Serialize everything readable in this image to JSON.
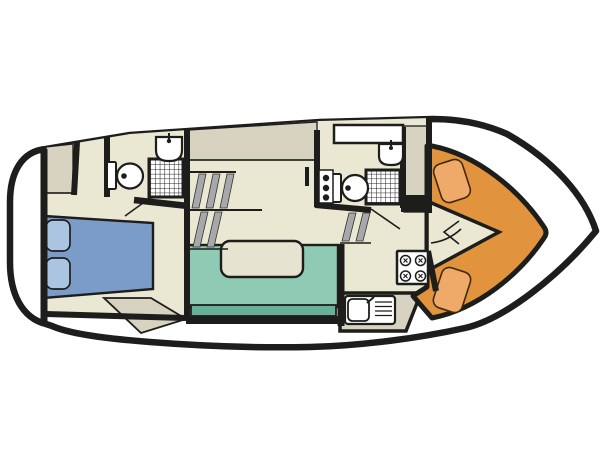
{
  "diagram": {
    "kind": "boat-floor-plan",
    "orientation": "bow-right-stern-left",
    "rooms": [
      {
        "id": "aft-cabin",
        "label": "aft cabin",
        "features": [
          "double-bed",
          "two-pillows",
          "wardrobe"
        ]
      },
      {
        "id": "aft-bathroom",
        "label": "aft bathroom",
        "features": [
          "toilet",
          "shower",
          "washbasin"
        ]
      },
      {
        "id": "companionway",
        "label": "companionway",
        "features": [
          "steps-to-deck"
        ]
      },
      {
        "id": "saloon",
        "label": "saloon",
        "features": [
          "u-shaped-sofa",
          "table"
        ]
      },
      {
        "id": "galley",
        "label": "galley",
        "features": [
          "four-burner-stove",
          "sink-with-drainer",
          "counter"
        ]
      },
      {
        "id": "forward-bathroom",
        "label": "forward bathroom",
        "features": [
          "toilet",
          "shower",
          "washbasin",
          "roof-window"
        ]
      },
      {
        "id": "bow-cockpit",
        "label": "bow cockpit",
        "features": [
          "seat-cushion-port",
          "seat-cushion-starboard",
          "walkway"
        ]
      }
    ],
    "features": [
      {
        "id": "hull",
        "label": "hull outline"
      },
      {
        "id": "swim-platform",
        "label": "stern swim platform"
      },
      {
        "id": "double-bed",
        "label": "double bed"
      },
      {
        "id": "sofa",
        "label": "u-shaped sofa"
      },
      {
        "id": "table",
        "label": "saloon table"
      },
      {
        "id": "stove",
        "label": "4-burner stove"
      },
      {
        "id": "galley-sink",
        "label": "galley sink with drainer"
      },
      {
        "id": "toilet-aft",
        "label": "aft toilet"
      },
      {
        "id": "toilet-fwd",
        "label": "forward toilet"
      },
      {
        "id": "shower-aft",
        "label": "aft shower"
      },
      {
        "id": "shower-fwd",
        "label": "forward shower"
      },
      {
        "id": "basin-aft",
        "label": "aft washbasin"
      },
      {
        "id": "basin-fwd",
        "label": "forward washbasin"
      },
      {
        "id": "steps-aft",
        "label": "aft companionway steps"
      },
      {
        "id": "steps-fwd",
        "label": "forward companionway steps"
      },
      {
        "id": "bow-seats",
        "label": "bow cockpit cushions"
      }
    ]
  },
  "colors": {
    "background": "#ffffff",
    "line": "#1d1d1b",
    "floor": "#eae7d3",
    "tan": "#d7d3c0",
    "bed": "#7b9cc9",
    "pillow": "#abc4e2",
    "sofa": "#8fcbb4",
    "sofa_edge": "#68b199",
    "table": "#e6e3d0",
    "cockpit": "#e2933d",
    "cockpit_seat": "#efa968",
    "steps_gray": "#a8a8aa",
    "fixture": "#ffffff"
  }
}
